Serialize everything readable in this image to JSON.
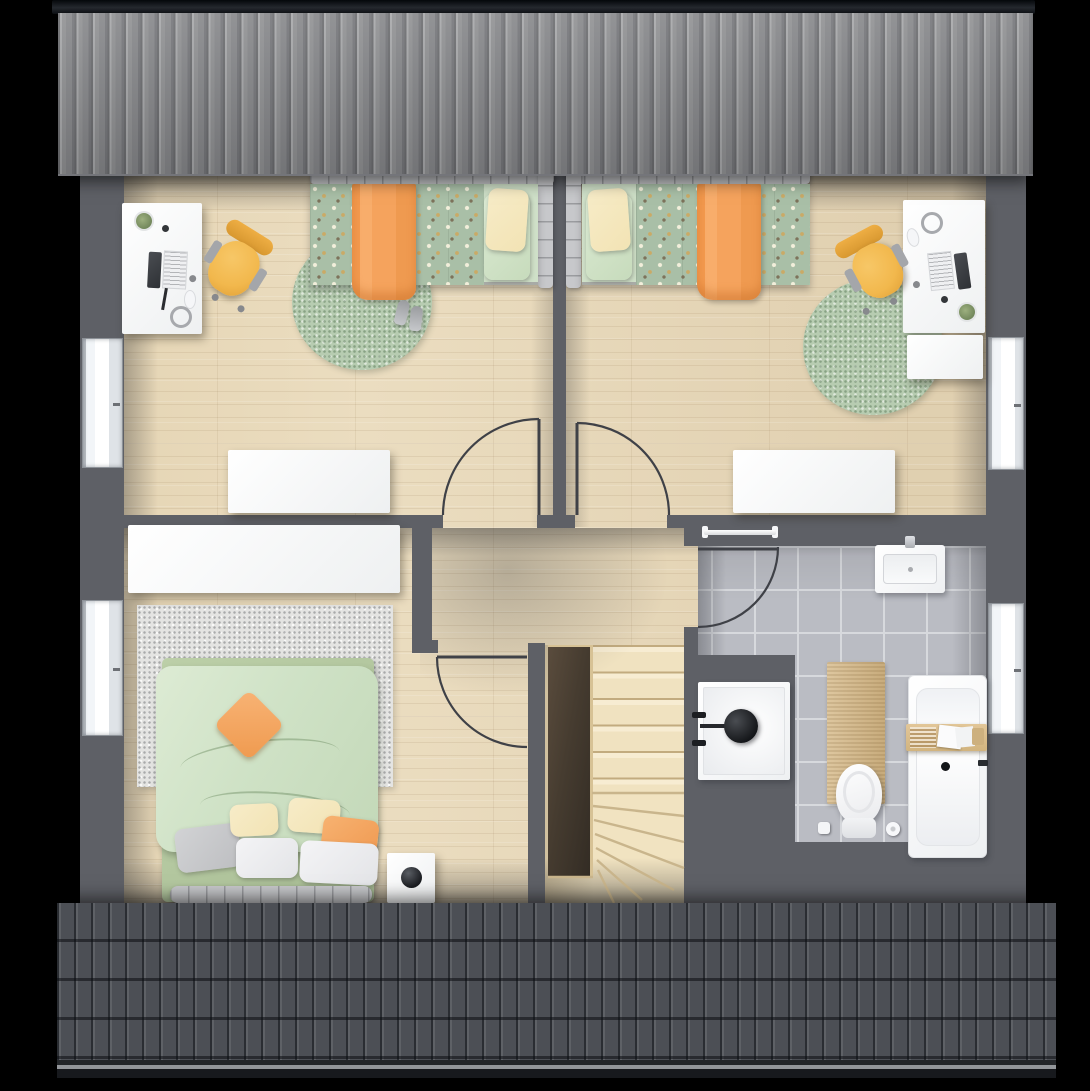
{
  "meta": {
    "title": "attic-floor-plan",
    "canvas_width": 1090,
    "canvas_height": 1091
  },
  "palette": {
    "bg": "#000000",
    "wall": "#5e6066",
    "wood": "#ebddc0",
    "tile": "#babcc3",
    "grout": "#d7d9dd",
    "roof_top": "#8c8d8f",
    "roof_ridge": "#14171b",
    "roof_bottom": "#4c4f55",
    "rug_green": "#b7ccb1",
    "rug_gray": "#e4e4e2",
    "duvet_polka": "#a9bfa7",
    "sheet_green": "#cfe0c8",
    "blanket_orange": "#f5a35d",
    "pillow_cream": "#f2e3b4",
    "bed_frame": "#c7c8cb",
    "duvet_master": "#cfe2c6",
    "chair_yellow": "#f2b84d",
    "white": "#f5f6f7",
    "tread": "#f1e3c1",
    "tread_line": "#c9b58c",
    "void_dark": "#43392e",
    "mat": "#d6ba8a",
    "fixture_dark": "#1b1d20",
    "window_glass": "#f2f5f8"
  },
  "floorplan": {
    "type": "residential-upper-floor-plan",
    "roofs": {
      "top": "ribbed-metal-roof-slope",
      "bottom": "tiled-roof-slope"
    },
    "rooms": {
      "bedroom_left": {
        "id": "bedroom-left",
        "furniture": [
          "desk",
          "laptop",
          "desk-plant",
          "desk-lamp-dot",
          "pen",
          "mouse",
          "headphones",
          "office-chair",
          "single-bed",
          "polka-dot-duvet",
          "orange-blanket",
          "pillow-cream",
          "pillow-green",
          "round-rug",
          "slippers",
          "dresser"
        ],
        "windows": 1,
        "door": "to-hallway"
      },
      "bedroom_right": {
        "id": "bedroom-right",
        "furniture": [
          "desk",
          "laptop",
          "phone",
          "desk-plant",
          "mouse",
          "headphones",
          "office-chair",
          "side-cabinet",
          "single-bed",
          "polka-dot-duvet",
          "orange-blanket",
          "pillow-cream",
          "pillow-green",
          "round-rug",
          "dresser"
        ],
        "windows": 1,
        "door": "to-hallway"
      },
      "master_bedroom": {
        "id": "master-bedroom",
        "furniture": [
          "wardrobe",
          "double-bed",
          "green-duvet",
          "orange-cushion",
          "pillows",
          "area-rug",
          "nightstand",
          "plant-ball"
        ],
        "windows": 1,
        "door": "to-hallway"
      },
      "bathroom": {
        "id": "bathroom",
        "furniture": [
          "towel-rail",
          "washbasin",
          "tap",
          "shower",
          "shower-fixture",
          "bath-mat",
          "toilet",
          "toilet-roll",
          "brush-cup",
          "bathtub",
          "bath-caddy",
          "drain",
          "tub-faucet"
        ],
        "windows": 1,
        "door": "to-hallway"
      },
      "hallway": {
        "id": "hallway",
        "connects": [
          "bedroom-left",
          "bedroom-right",
          "master-bedroom",
          "bathroom",
          "staircase"
        ]
      },
      "staircase": {
        "id": "staircase",
        "features": [
          "straight-treads",
          "winder-treads",
          "stairwell-void"
        ]
      }
    },
    "openings": {
      "doors": 4,
      "windows": 4,
      "door_swings": [
        "bedroom-left",
        "bedroom-right",
        "master-bedroom",
        "bathroom"
      ]
    }
  }
}
